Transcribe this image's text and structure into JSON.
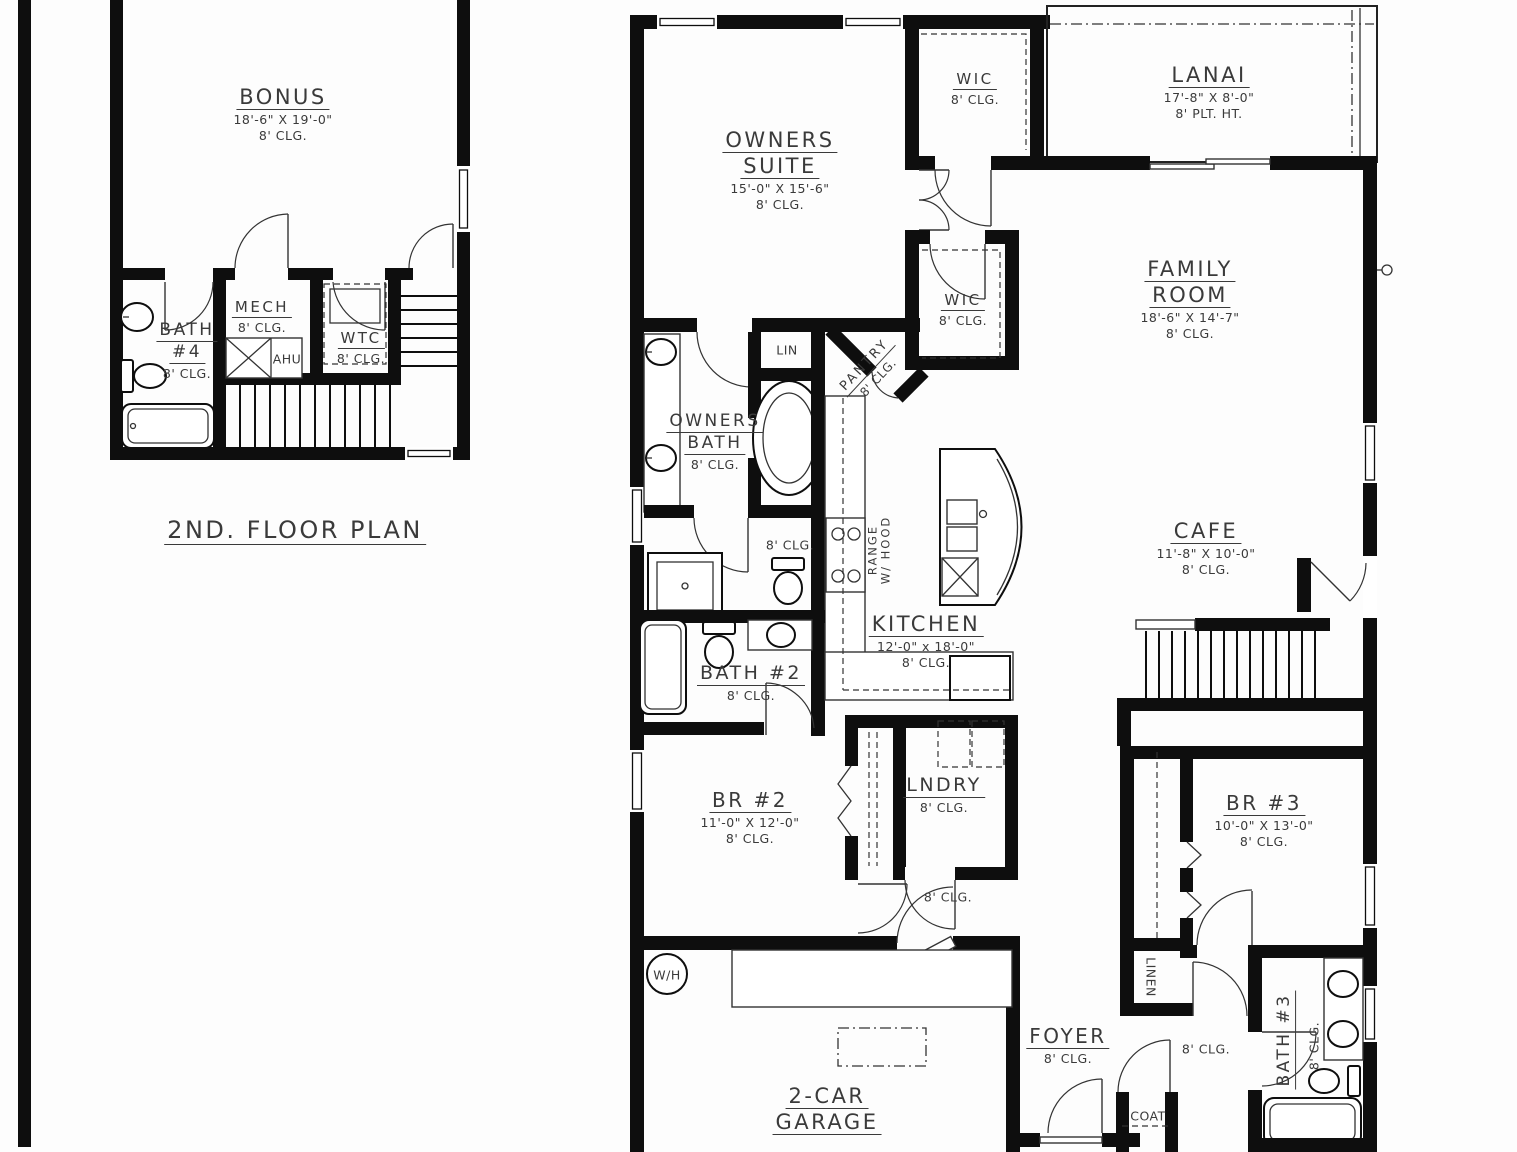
{
  "sheet": {
    "second_floor_title": "2ND. FLOOR PLAN"
  },
  "rooms": {
    "bonus": {
      "name": [
        "BONUS"
      ],
      "dims": "18'-6\" X 19'-0\"",
      "clg": "8' CLG."
    },
    "bath4": {
      "name": [
        "BATH",
        "#4"
      ],
      "clg": "8' CLG."
    },
    "mech": {
      "name": [
        "MECH"
      ],
      "clg": "8' CLG."
    },
    "ahu": {
      "label": "AHU"
    },
    "wtc": {
      "name": [
        "WTC"
      ],
      "clg": "8' CLG."
    },
    "owners_suite": {
      "name": [
        "OWNERS",
        "SUITE"
      ],
      "dims": "15'-0\" X 15'-6\"",
      "clg": "8' CLG."
    },
    "wic_top": {
      "name": [
        "WIC"
      ],
      "clg": "8' CLG."
    },
    "lanai": {
      "name": [
        "LANAI"
      ],
      "dims": "17'-8\" X 8'-0\"",
      "clg": "8' PLT. HT."
    },
    "family_room": {
      "name": [
        "FAMILY",
        "ROOM"
      ],
      "dims": "18'-6\" X 14'-7\"",
      "clg": "8' CLG."
    },
    "wic_mid": {
      "name": [
        "WIC"
      ],
      "clg": "8' CLG."
    },
    "lin": {
      "label": "LIN"
    },
    "pantry": {
      "name": [
        "PANTRY"
      ],
      "clg": "8' CLG."
    },
    "owners_bath": {
      "name": [
        "OWNERS",
        "BATH"
      ],
      "clg": "8' CLG."
    },
    "owners_wc": {
      "clg": "8' CLG."
    },
    "range": {
      "label": [
        "RANGE",
        "W/ HOOD"
      ]
    },
    "kitchen": {
      "name": [
        "KITCHEN"
      ],
      "dims": "12'-0\" x 18'-0\"",
      "clg": "8' CLG."
    },
    "cafe": {
      "name": [
        "CAFE"
      ],
      "dims": "11'-8\" X 10'-0\"",
      "clg": "8' CLG."
    },
    "bath2": {
      "name": [
        "BATH #2"
      ],
      "clg": "8' CLG."
    },
    "br2": {
      "name": [
        "BR #2"
      ],
      "dims": "11'-0\" X 12'-0\"",
      "clg": "8' CLG."
    },
    "lndry": {
      "name": [
        "LNDRY"
      ],
      "clg": "8' CLG."
    },
    "br3": {
      "name": [
        "BR #3"
      ],
      "dims": "10'-0\" X 13'-0\"",
      "clg": "8' CLG."
    },
    "hall_bedrooms": {
      "clg": "8' CLG."
    },
    "water_heater": {
      "label": "W/H"
    },
    "garage": {
      "name": [
        "2-CAR",
        "GARAGE"
      ]
    },
    "foyer": {
      "name": [
        "FOYER"
      ],
      "clg": "8' CLG."
    },
    "coat": {
      "label": "COAT"
    },
    "hall_foyer": {
      "clg": "8' CLG."
    },
    "linen": {
      "label": "LINEN"
    },
    "bath3": {
      "name": [
        "BATH #3"
      ],
      "clg": "8' CLG."
    }
  },
  "colors": {
    "wall": "#0e0e0e",
    "line": "#333333",
    "text": "#3a3a3a",
    "background": "#fdfdfd"
  }
}
